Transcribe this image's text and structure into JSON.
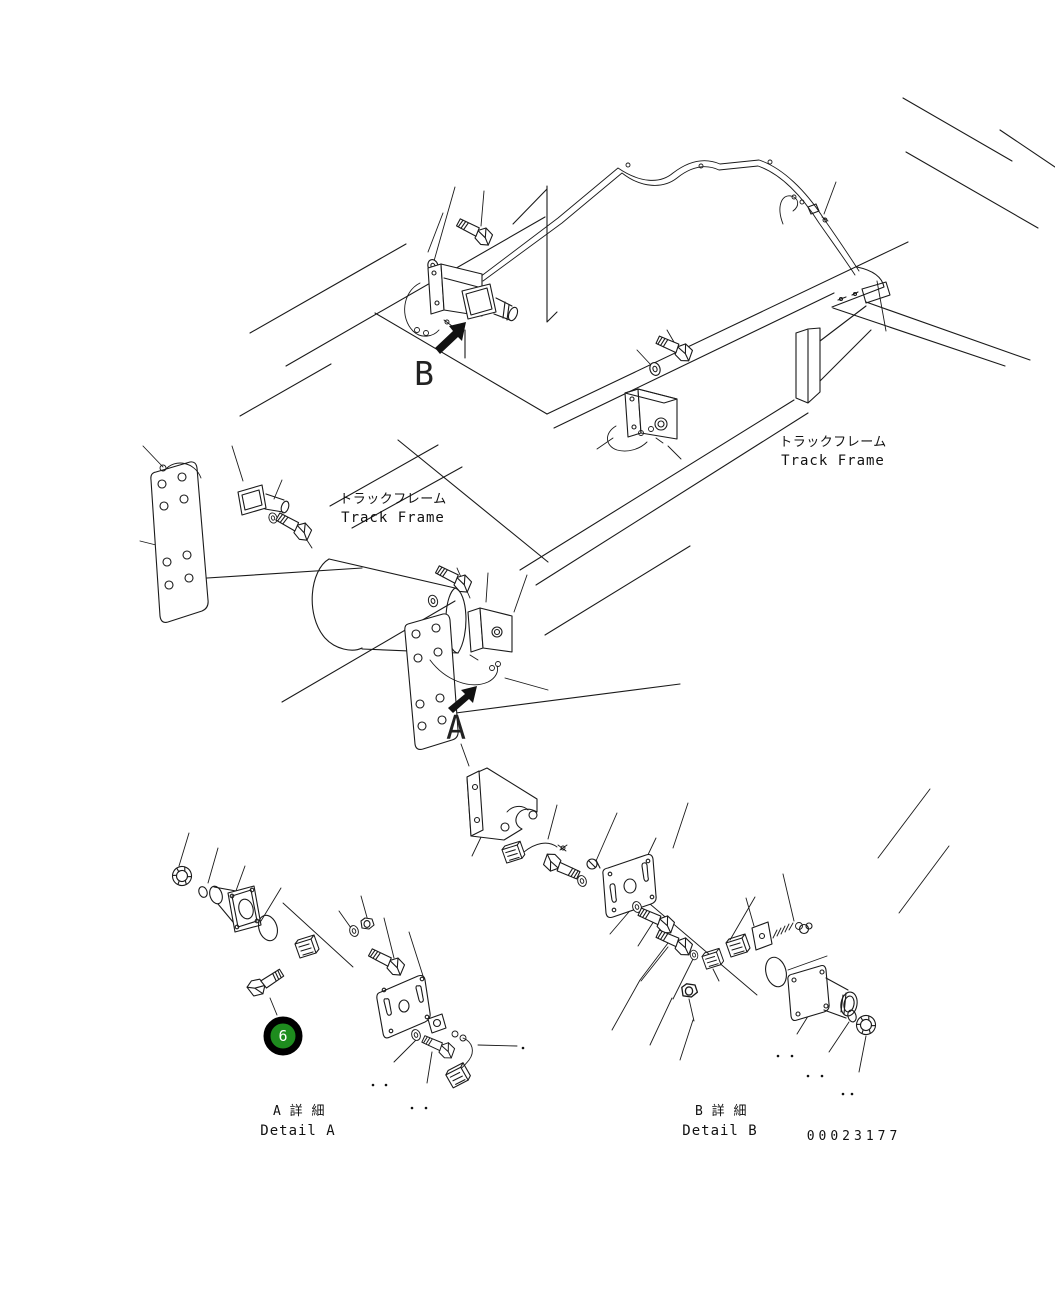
{
  "figure": {
    "drawing_number": "00023177",
    "callout": {
      "number": "6",
      "fill_color": "#1E8C1E",
      "ring_color": "#000000",
      "text_color": "#FFFFFF"
    },
    "view_markers": {
      "top": "B",
      "middle": "A"
    },
    "labels": {
      "track_frame_left": {
        "jp": "トラックフレーム",
        "en": "Track Frame"
      },
      "track_frame_right": {
        "jp": "トラックフレーム",
        "en": "Track Frame"
      },
      "detail_a": {
        "jp": "A 詳 細",
        "en": "Detail A"
      },
      "detail_b": {
        "jp": "B 詳 細",
        "en": "Detail B"
      }
    },
    "colors": {
      "line": "#1a1a1a",
      "background": "#ffffff"
    }
  }
}
